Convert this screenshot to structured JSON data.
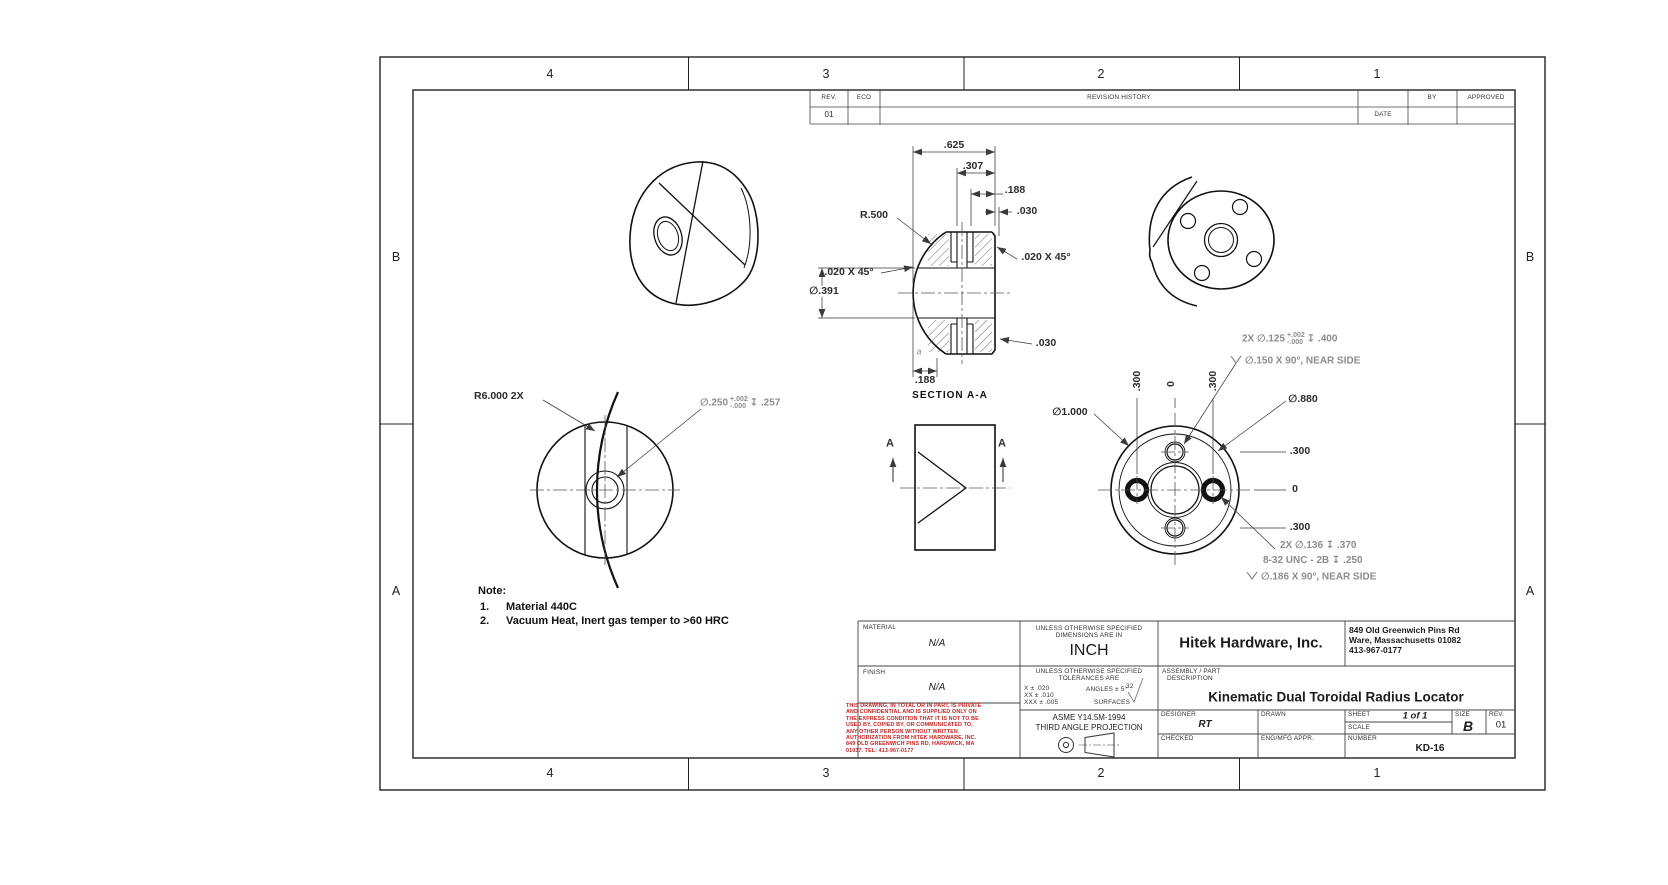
{
  "zones": {
    "top": [
      "4",
      "3",
      "2",
      "1"
    ],
    "bottom": [
      "4",
      "3",
      "2",
      "1"
    ],
    "left": [
      "B",
      "A"
    ],
    "right": [
      "B",
      "A"
    ]
  },
  "revision_table": {
    "rev_header": "REV.",
    "eco_header": "ECO",
    "history_header": "REVISION HISTORY",
    "date_header": "DATE",
    "by_header": "BY",
    "approved_header": "APPROVED",
    "row": {
      "rev": "01"
    }
  },
  "notes": {
    "label": "Note:",
    "items": [
      {
        "num": "1.",
        "text": "Material 440C"
      },
      {
        "num": "2.",
        "text": "Vacuum Heat, Inert gas temper to >60 HRC"
      }
    ]
  },
  "section_view": {
    "label": "SECTION A-A",
    "dim_625": ".625",
    "dim_307": ".307",
    "dim_188_top": ".188",
    "dim_030_top": ".030",
    "radius": "R.500",
    "chamfer_left": ".020 X 45°",
    "chamfer_right": ".020 X 45°",
    "bore_dia": "∅.391",
    "dim_030_bottom": ".030",
    "dim_188_bottom": ".188",
    "datum": "a"
  },
  "front_view": {
    "radius_callout": "R6.000 2X",
    "hole_dia": "∅.250",
    "hole_tol_plus": "+.002",
    "hole_tol_minus": "-.000",
    "hole_depth": "↧ .257"
  },
  "side_view": {
    "section_letter_left": "A",
    "section_letter_right": "A"
  },
  "back_view": {
    "dia_outer": "∅1.000",
    "dia_bolt_circle": "∅.880",
    "ordinate_right": [
      ".300",
      "0",
      ".300"
    ],
    "ordinate_top": [
      ".300",
      "0",
      ".300"
    ],
    "callout_top": {
      "qty_dia": "2X  ∅.125",
      "tol_plus": "+.002",
      "tol_minus": "-.000",
      "depth": "↧ .400",
      "csk": "∅.150  X 90°, NEAR SIDE"
    },
    "callout_bottom": {
      "line1": "2X  ∅.136  ↧ .370",
      "line2": "8-32 UNC  - 2B  ↧ .250",
      "csk": "∅.186 X 90°, NEAR SIDE"
    }
  },
  "title_block": {
    "material_label": "MATERIAL",
    "material_value": "N/A",
    "finish_label": "FINISH",
    "finish_value": "N/A",
    "units_line1": "UNLESS OTHERWISE SPECIFIED",
    "units_line2": "DIMENSIONS ARE IN",
    "units_value": "INCH",
    "tol_line1": "UNLESS OTHERWISE SPECIFIED",
    "tol_line2": "TOLERANCES ARE",
    "tol_x": "X ± .020",
    "tol_xx": "XX ± .010",
    "tol_xxx": "XXX ± .005",
    "tol_angles": "ANGLES ± 5°",
    "tol_surfaces_label": "SURFACES",
    "tol_surfaces_value": "32",
    "standard": "ASME Y14.5M-1994",
    "projection": "THIRD ANGLE PROJECTION",
    "company": "Hitek Hardware, Inc.",
    "address_line1": "849 Old Greenwich Pins Rd",
    "address_line2": "Ware, Massachusetts 01082",
    "address_line3": "413-967-0177",
    "assembly_label_line1": "ASSEMBLY / PART",
    "assembly_label_line2": "DESCRIPTION",
    "description": "Kinematic Dual Toroidal Radius Locator",
    "designer_label": "DESIGNER",
    "designer_value": "RT",
    "drawn_label": "DRAWN",
    "checked_label": "CHECKED",
    "eng_appr_label": "ENG/MFG APPR.",
    "sheet_label": "SHEET",
    "sheet_value": "1 of 1",
    "scale_label": "SCALE",
    "size_label": "SIZE",
    "size_value": "B",
    "rev_label": "REV.",
    "rev_value": "01",
    "number_label": "NUMBER",
    "number_value": "KD-16",
    "disclaimer": [
      "THIS DRAWING, IN TOTAL OR IN PART, IS PRIVATE",
      "AND CONFIDENTIAL AND IS SUPPLIED ONLY ON",
      "THE EXPRESS CONDITION THAT IT IS NOT TO BE",
      "USED BY, COPIED BY, OR COMMUNICATED TO,",
      "ANY OTHER PERSON WITHOUT WRITTEN",
      "AUTHORIZATION FROM HITEK HARDWARE, INC.",
      "849 OLD GREENWICH PINS RD, HARDWICK, MA",
      "01037.  TEL: 413-967-0177"
    ]
  }
}
